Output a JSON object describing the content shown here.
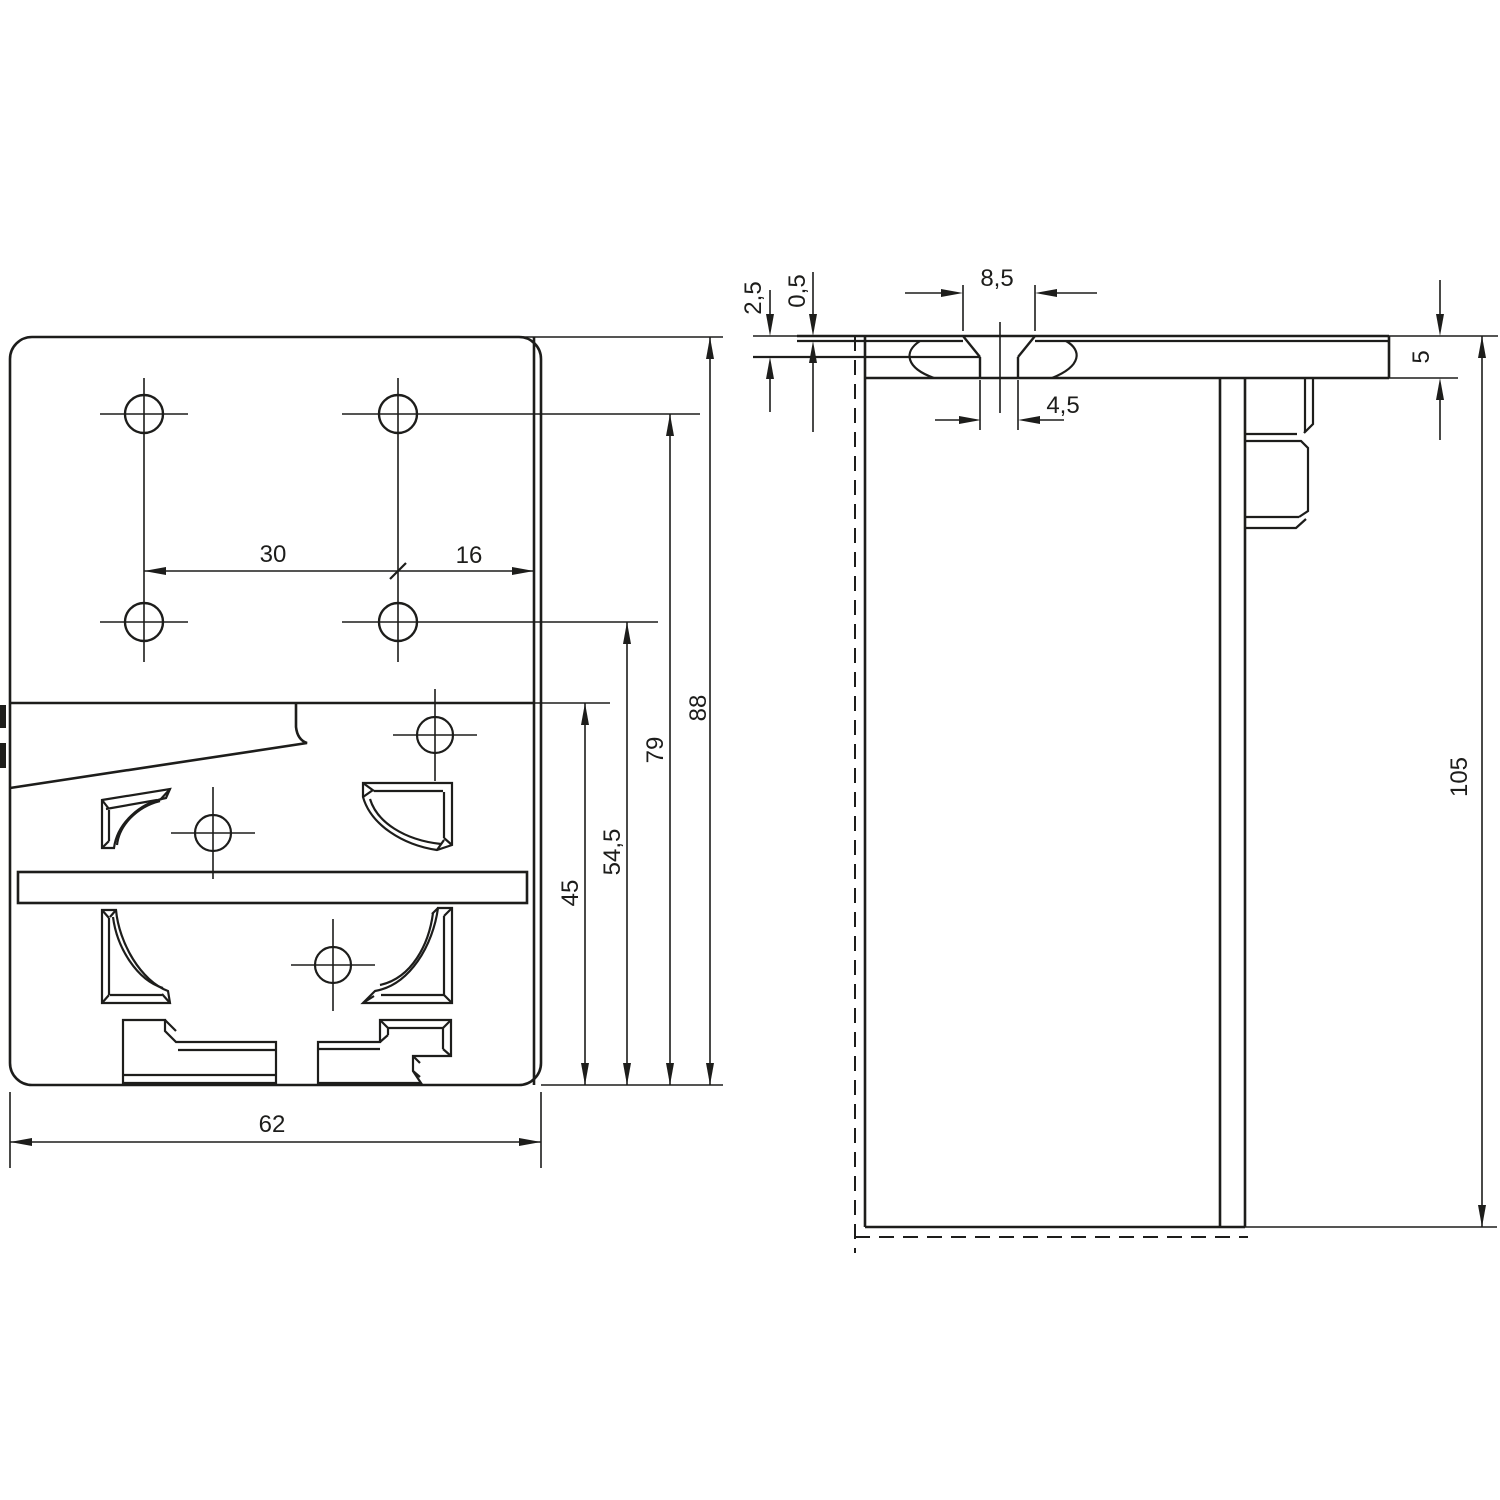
{
  "drawing": {
    "background_color": "#ffffff",
    "line_color": "#1d1d1b",
    "front_view": {
      "dims": {
        "w30": "30",
        "w16": "16",
        "h45": "45",
        "h54_5": "54,5",
        "h79": "79",
        "h88": "88",
        "w62": "62"
      }
    },
    "side_view": {
      "dims": {
        "t2_5": "2,5",
        "t0_5": "0,5",
        "w8_5": "8,5",
        "d4_5": "4,5",
        "t5": "5",
        "h105": "105"
      }
    }
  }
}
